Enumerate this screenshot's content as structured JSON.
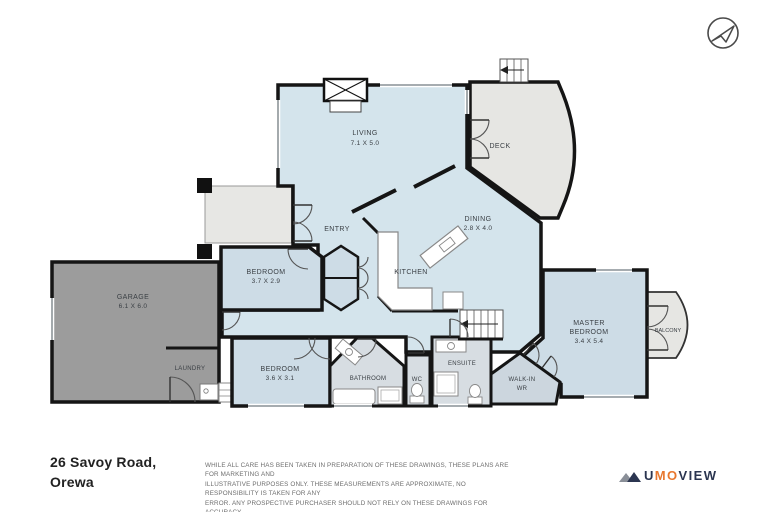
{
  "plan": {
    "rooms": {
      "living": {
        "name": "LIVING",
        "dims": "7.1 X 5.0"
      },
      "deck": {
        "name": "DECK"
      },
      "dining": {
        "name": "DINING",
        "dims": "2.8 X 4.0"
      },
      "entry": {
        "name": "ENTRY"
      },
      "kitchen": {
        "name": "KITCHEN"
      },
      "bedroom2": {
        "name": "BEDROOM",
        "dims": "3.7 X 2.9"
      },
      "garage": {
        "name": "GARAGE",
        "dims": "6.1 X 6.0"
      },
      "laundry": {
        "name": "LAUNDRY"
      },
      "bedroom3": {
        "name": "BEDROOM",
        "dims": "3.6 X 3.1"
      },
      "bathroom": {
        "name": "BATHROOM"
      },
      "wc": {
        "name": "WC"
      },
      "ensuite": {
        "name": "ENSUITE"
      },
      "walkin": {
        "name": "WALK-IN",
        "name2": "WR"
      },
      "master": {
        "name": "MASTER",
        "name2": "BEDROOM",
        "dims": "3.4 X 5.4"
      },
      "balcony": {
        "name": "BALCONY"
      }
    }
  },
  "footer": {
    "address_line1": "26 Savoy Road,",
    "address_line2": "Orewa",
    "disclaimer_lines": [
      "WHILE ALL CARE HAS BEEN TAKEN IN PREPARATION OF THESE DRAWINGS, THESE PLANS ARE FOR MARKETING AND",
      "ILLUSTRATIVE PURPOSES ONLY. THESE MEASUREMENTS ARE APPROXIMATE, NO RESPONSIBILITY IS TAKEN FOR ANY",
      "ERROR. ANY PROSPECTIVE PURCHASER SHOULD NOT RELY ON THESE DRAWINGS FOR ACCURACY.",
      "ALL RIGHTS RESERVED"
    ]
  },
  "logo": {
    "text_u": "U",
    "text_mo": "MO",
    "text_view": "VIEW"
  },
  "icons": {
    "compass": "north-arrow-icon",
    "logo_mark": "umoview-mountain-icon"
  },
  "colors": {
    "open_plan": "#d4e4ec",
    "bedroom": "#cddce6",
    "wet_area": "#d7dde2",
    "deck": "#e6e6e3",
    "garage": "#9c9c9c",
    "wall": "#151515",
    "logo_navy": "#2b3550",
    "logo_orange": "#e8772e"
  }
}
